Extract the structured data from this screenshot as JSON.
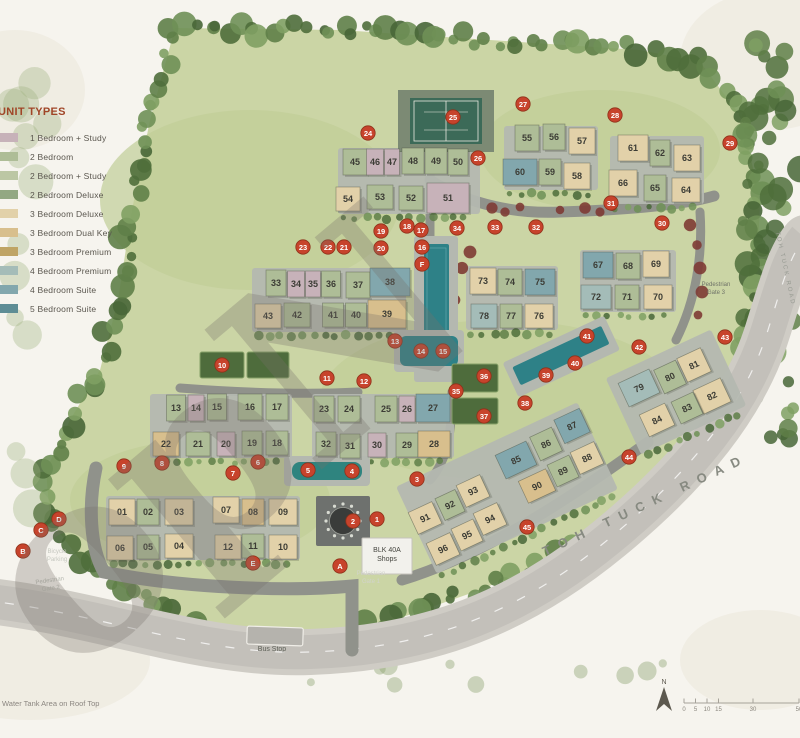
{
  "legend": {
    "title": "UNIT TYPES",
    "items": [
      {
        "label": "1 Bedroom + Study",
        "color": "#c7b2b9",
        "key": "1bs"
      },
      {
        "label": "2 Bedroom",
        "color": "#aebd97",
        "key": "2b"
      },
      {
        "label": "2 Bedroom + Study",
        "color": "#bcc7a4",
        "key": "2bs"
      },
      {
        "label": "2 Bedroom Deluxe",
        "color": "#93a883",
        "key": "2bd"
      },
      {
        "label": "3 Bedroom Deluxe",
        "color": "#e2d1a9",
        "key": "3bd"
      },
      {
        "label": "3 Bedroom Dual Key",
        "color": "#d8bf8d",
        "key": "3bdk"
      },
      {
        "label": "3 Bedroom Premium",
        "color": "#bfa465",
        "key": "3bp"
      },
      {
        "label": "4 Bedroom Premium",
        "color": "#a4bcb8",
        "key": "4bp"
      },
      {
        "label": "4 Bedroom Suite",
        "color": "#82a7ad",
        "key": "4bs"
      },
      {
        "label": "5 Bedroom Suite",
        "color": "#5e8d95",
        "key": "5bs"
      }
    ]
  },
  "map": {
    "buildings_format": "[label, x, y, unitTypeKey, w, h, rotationDeg]",
    "buildings": [
      [
        "45",
        355,
        162,
        "2b",
        24,
        26,
        0
      ],
      [
        "46",
        375,
        162,
        "1bs",
        17,
        26,
        0
      ],
      [
        "47",
        392,
        162,
        "1bs",
        15,
        26,
        0
      ],
      [
        "48",
        413,
        161,
        "2b",
        22,
        26,
        0
      ],
      [
        "49",
        436,
        161,
        "2b",
        22,
        26,
        0
      ],
      [
        "50",
        458,
        162,
        "2b",
        20,
        26,
        0
      ],
      [
        "54",
        348,
        199,
        "3bd",
        24,
        24,
        0
      ],
      [
        "53",
        380,
        197,
        "2b",
        26,
        24,
        0
      ],
      [
        "52",
        411,
        198,
        "2b",
        24,
        24,
        0
      ],
      [
        "51",
        448,
        198,
        "1bs",
        42,
        30,
        0
      ],
      [
        "55",
        527,
        138,
        "2b",
        24,
        26,
        0
      ],
      [
        "56",
        554,
        137,
        "2b",
        22,
        26,
        0
      ],
      [
        "57",
        582,
        141,
        "3bd",
        26,
        26,
        0
      ],
      [
        "60",
        520,
        172,
        "4bs",
        34,
        26,
        0
      ],
      [
        "59",
        550,
        172,
        "2b",
        22,
        26,
        0
      ],
      [
        "58",
        577,
        176,
        "3bd",
        26,
        26,
        0
      ],
      [
        "61",
        633,
        148,
        "3bd",
        30,
        26,
        0
      ],
      [
        "62",
        660,
        153,
        "2b",
        20,
        26,
        0
      ],
      [
        "63",
        687,
        158,
        "3bd",
        26,
        26,
        0
      ],
      [
        "66",
        623,
        183,
        "3bd",
        28,
        26,
        0
      ],
      [
        "65",
        655,
        188,
        "2b",
        22,
        26,
        0
      ],
      [
        "64",
        686,
        190,
        "3bd",
        28,
        24,
        0
      ],
      [
        "33",
        276,
        283,
        "2b",
        20,
        26,
        0
      ],
      [
        "34",
        296,
        284,
        "1bs",
        17,
        26,
        0
      ],
      [
        "35",
        313,
        284,
        "1bs",
        15,
        26,
        0
      ],
      [
        "36",
        331,
        284,
        "2b",
        19,
        26,
        0
      ],
      [
        "37",
        358,
        285,
        "2b",
        24,
        26,
        0
      ],
      [
        "38",
        390,
        282,
        "4bs",
        40,
        28,
        0
      ],
      [
        "43",
        268,
        316,
        "3bd",
        26,
        24,
        0
      ],
      [
        "42",
        297,
        315,
        "2b",
        26,
        24,
        0
      ],
      [
        "41",
        333,
        315,
        "2b",
        21,
        24,
        0
      ],
      [
        "40",
        356,
        315,
        "2b",
        21,
        24,
        0
      ],
      [
        "39",
        387,
        314,
        "3bdk",
        38,
        28,
        0
      ],
      [
        "73",
        483,
        281,
        "3bd",
        26,
        26,
        0
      ],
      [
        "74",
        510,
        282,
        "2b",
        24,
        26,
        0
      ],
      [
        "75",
        540,
        282,
        "4bs",
        30,
        26,
        0
      ],
      [
        "78",
        484,
        316,
        "4bp",
        26,
        24,
        0
      ],
      [
        "77",
        511,
        316,
        "2b",
        22,
        24,
        0
      ],
      [
        "76",
        539,
        316,
        "3bd",
        28,
        24,
        0
      ],
      [
        "67",
        598,
        265,
        "4bs",
        30,
        26,
        0
      ],
      [
        "68",
        628,
        266,
        "2b",
        24,
        26,
        0
      ],
      [
        "69",
        656,
        264,
        "3bd",
        26,
        26,
        0
      ],
      [
        "72",
        596,
        297,
        "4bp",
        30,
        24,
        0
      ],
      [
        "71",
        627,
        297,
        "2b",
        24,
        24,
        0
      ],
      [
        "70",
        658,
        297,
        "3bd",
        28,
        24,
        0
      ],
      [
        "13",
        176,
        408,
        "2b",
        19,
        26,
        0
      ],
      [
        "14",
        196,
        408,
        "1bs",
        16,
        26,
        0
      ],
      [
        "15",
        217,
        407,
        "2b",
        19,
        26,
        0
      ],
      [
        "16",
        250,
        407,
        "2b",
        24,
        26,
        0
      ],
      [
        "17",
        277,
        407,
        "2b",
        22,
        26,
        0
      ],
      [
        "22",
        166,
        444,
        "3bdk",
        26,
        24,
        0
      ],
      [
        "21",
        198,
        444,
        "2b",
        24,
        24,
        0
      ],
      [
        "20",
        226,
        444,
        "1bs",
        18,
        24,
        0
      ],
      [
        "19",
        252,
        443,
        "2b",
        20,
        24,
        0
      ],
      [
        "18",
        277,
        443,
        "2b",
        22,
        24,
        0
      ],
      [
        "23",
        324,
        409,
        "2b",
        20,
        26,
        0
      ],
      [
        "24",
        349,
        409,
        "2b",
        22,
        26,
        0
      ],
      [
        "25",
        386,
        409,
        "2b",
        22,
        26,
        0
      ],
      [
        "26",
        407,
        409,
        "1bs",
        16,
        26,
        0
      ],
      [
        "27",
        433,
        408,
        "4bs",
        34,
        28,
        0
      ],
      [
        "32",
        326,
        444,
        "2b",
        20,
        24,
        0
      ],
      [
        "31",
        350,
        446,
        "2b",
        20,
        24,
        0
      ],
      [
        "30",
        377,
        445,
        "1bs",
        18,
        24,
        0
      ],
      [
        "29",
        407,
        445,
        "2b",
        22,
        24,
        0
      ],
      [
        "28",
        434,
        444,
        "3bdk",
        32,
        26,
        0
      ],
      [
        "01",
        122,
        512,
        "3bd",
        26,
        26,
        0
      ],
      [
        "02",
        148,
        512,
        "2b",
        22,
        26,
        0
      ],
      [
        "03",
        179,
        512,
        "3bd",
        28,
        26,
        0
      ],
      [
        "07",
        226,
        510,
        "3bd",
        26,
        26,
        0
      ],
      [
        "08",
        253,
        512,
        "3bdk",
        22,
        26,
        0
      ],
      [
        "09",
        283,
        512,
        "3bd",
        28,
        26,
        0
      ],
      [
        "06",
        120,
        548,
        "3bd",
        26,
        24,
        0
      ],
      [
        "05",
        148,
        547,
        "2b",
        22,
        24,
        0
      ],
      [
        "04",
        179,
        546,
        "3bd",
        28,
        24,
        0
      ],
      [
        "12",
        228,
        547,
        "3bd",
        26,
        24,
        0
      ],
      [
        "11",
        253,
        546,
        "2b",
        22,
        24,
        0
      ],
      [
        "10",
        283,
        547,
        "3bd",
        28,
        24,
        0
      ],
      [
        "91",
        425,
        518,
        "3bd",
        26,
        24,
        -25
      ],
      [
        "92",
        450,
        505,
        "2b",
        22,
        24,
        -25
      ],
      [
        "93",
        473,
        491,
        "3bd",
        26,
        24,
        -25
      ],
      [
        "94",
        490,
        519,
        "3bd",
        26,
        24,
        -25
      ],
      [
        "95",
        467,
        535,
        "3bd",
        24,
        24,
        -25
      ],
      [
        "96",
        443,
        549,
        "3bd",
        26,
        24,
        -25
      ],
      [
        "85",
        516,
        460,
        "4bs",
        34,
        26,
        -25
      ],
      [
        "86",
        546,
        444,
        "2b",
        24,
        26,
        -25
      ],
      [
        "87",
        572,
        426,
        "4bs",
        28,
        26,
        -25
      ],
      [
        "88",
        587,
        458,
        "3bd",
        26,
        24,
        -25
      ],
      [
        "89",
        563,
        471,
        "2b",
        24,
        24,
        -25
      ],
      [
        "90",
        537,
        486,
        "3bdk",
        30,
        24,
        -25
      ],
      [
        "79",
        639,
        388,
        "4bp",
        34,
        26,
        -25
      ],
      [
        "80",
        670,
        377,
        "2b",
        24,
        26,
        -25
      ],
      [
        "81",
        694,
        365,
        "3bd",
        26,
        26,
        -25
      ],
      [
        "82",
        712,
        396,
        "3bd",
        30,
        26,
        -25
      ],
      [
        "83",
        687,
        408,
        "2b",
        24,
        24,
        -25
      ],
      [
        "84",
        657,
        420,
        "3bd",
        28,
        24,
        -25
      ]
    ],
    "markers_format": "[label, x, y]",
    "facility_markers": [
      [
        "1",
        377,
        519
      ],
      [
        "2",
        353,
        521
      ],
      [
        "3",
        417,
        479
      ],
      [
        "4",
        352,
        471
      ],
      [
        "5",
        308,
        470
      ],
      [
        "6",
        258,
        462
      ],
      [
        "7",
        233,
        473
      ],
      [
        "8",
        162,
        463
      ],
      [
        "9",
        124,
        466
      ],
      [
        "10",
        222,
        365
      ],
      [
        "11",
        327,
        378
      ],
      [
        "12",
        364,
        381
      ],
      [
        "13",
        395,
        341
      ],
      [
        "14",
        421,
        351
      ],
      [
        "15",
        443,
        351
      ],
      [
        "16",
        422,
        247
      ],
      [
        "17",
        421,
        230
      ],
      [
        "18",
        407,
        226
      ],
      [
        "19",
        381,
        231
      ],
      [
        "20",
        381,
        248
      ],
      [
        "21",
        344,
        247
      ],
      [
        "22",
        328,
        247
      ],
      [
        "23",
        303,
        247
      ],
      [
        "24",
        368,
        133
      ],
      [
        "25",
        453,
        117
      ],
      [
        "26",
        478,
        158
      ],
      [
        "27",
        523,
        104
      ],
      [
        "28",
        615,
        115
      ],
      [
        "29",
        730,
        143
      ],
      [
        "30",
        662,
        223
      ],
      [
        "31",
        611,
        203
      ],
      [
        "32",
        536,
        227
      ],
      [
        "33",
        495,
        227
      ],
      [
        "34",
        457,
        228
      ],
      [
        "35",
        456,
        391
      ],
      [
        "36",
        484,
        376
      ],
      [
        "37",
        484,
        416
      ],
      [
        "38",
        525,
        403
      ],
      [
        "39",
        546,
        375
      ],
      [
        "40",
        575,
        363
      ],
      [
        "41",
        587,
        336
      ],
      [
        "42",
        639,
        347
      ],
      [
        "43",
        725,
        337
      ],
      [
        "44",
        629,
        457
      ],
      [
        "45",
        527,
        527
      ]
    ],
    "letter_markers": [
      [
        "A",
        340,
        566
      ],
      [
        "B",
        23,
        551
      ],
      [
        "C",
        41,
        530
      ],
      [
        "D",
        59,
        519
      ],
      [
        "E",
        253,
        563
      ],
      [
        "F",
        422,
        264
      ]
    ],
    "labels": [
      {
        "id": "shops",
        "lines": [
          "BLK 40A",
          "Shops"
        ],
        "x": 387,
        "y": 552,
        "size": 7,
        "color": "#45453f",
        "rot": 0
      },
      {
        "id": "pedestrian-gate-1",
        "lines": [
          "Pedestrian",
          "Gate 1"
        ],
        "x": 371,
        "y": 575,
        "size": 6,
        "color": "#d2d4cb",
        "rot": 0
      },
      {
        "id": "pedestrian-gate-2",
        "lines": [
          "Pedestrian",
          "Gate 2"
        ],
        "x": 50,
        "y": 582,
        "size": 6,
        "color": "#b7b9b1",
        "rot": -8
      },
      {
        "id": "pedestrian-gate-3",
        "lines": [
          "Pedestrian",
          "Gate 3"
        ],
        "x": 716,
        "y": 286,
        "size": 6,
        "color": "#6f7268",
        "rot": 0
      },
      {
        "id": "bicycle-parking",
        "lines": [
          "Bicycle",
          "Parking"
        ],
        "x": 57,
        "y": 553,
        "size": 6,
        "color": "#c6c8c0",
        "rot": 0
      },
      {
        "id": "bus-stop",
        "lines": [
          "Bus Stop"
        ],
        "x": 272,
        "y": 651,
        "size": 7,
        "color": "#5c5f56",
        "rot": 0
      }
    ],
    "road_name": "TOH TUCK ROAD"
  },
  "scale_bar": {
    "north_label": "N",
    "ticks": [
      "0",
      "5",
      "10",
      "15",
      "30",
      "50"
    ]
  },
  "watermark": "opN",
  "footnote": "Water Tank Area on Roof Top"
}
